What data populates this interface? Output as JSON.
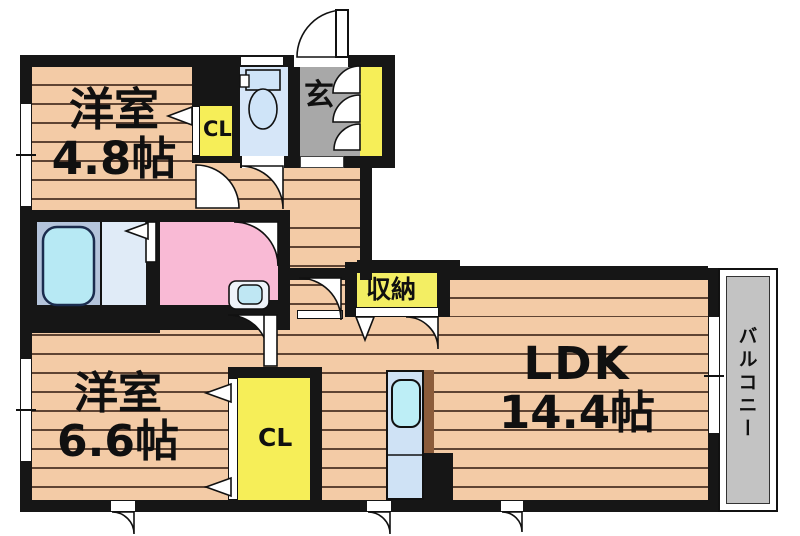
{
  "plan_title": "apartment-floorplan",
  "rooms": {
    "bedroom1": {
      "name": "洋室",
      "size": "4.8帖"
    },
    "bedroom2": {
      "name": "洋室",
      "size": "6.6帖"
    },
    "ldk": {
      "name": "LDK",
      "size": "14.4帖"
    },
    "entrance": {
      "label": "玄"
    },
    "closet_upper": {
      "label": "CL"
    },
    "closet_lower": {
      "label": "CL"
    },
    "storage": {
      "label": "収納"
    },
    "balcony": {
      "label": "バルコニー"
    }
  },
  "colors": {
    "wall": "#161616",
    "wood": "#f3cba6",
    "wood_line": "#5f4433",
    "toilet_floor": "#d6e6f8",
    "fixture_blue": "#cfe4f8",
    "genkan": "#a8a8a8",
    "cabinet_yellow": "#f6ee58",
    "storage_yellow": "#f3ee63",
    "washroom_pink": "#f9bad5",
    "bath_panel": "#b4c4db",
    "bath_wash": "#e0ebf7",
    "tub": "#b7e9f4",
    "balcony_gray": "#c3c3c3",
    "kitchen": "#cfe2f5",
    "kitchen_sink": "#bdeef6",
    "counter_brown": "#8b5c3b"
  }
}
